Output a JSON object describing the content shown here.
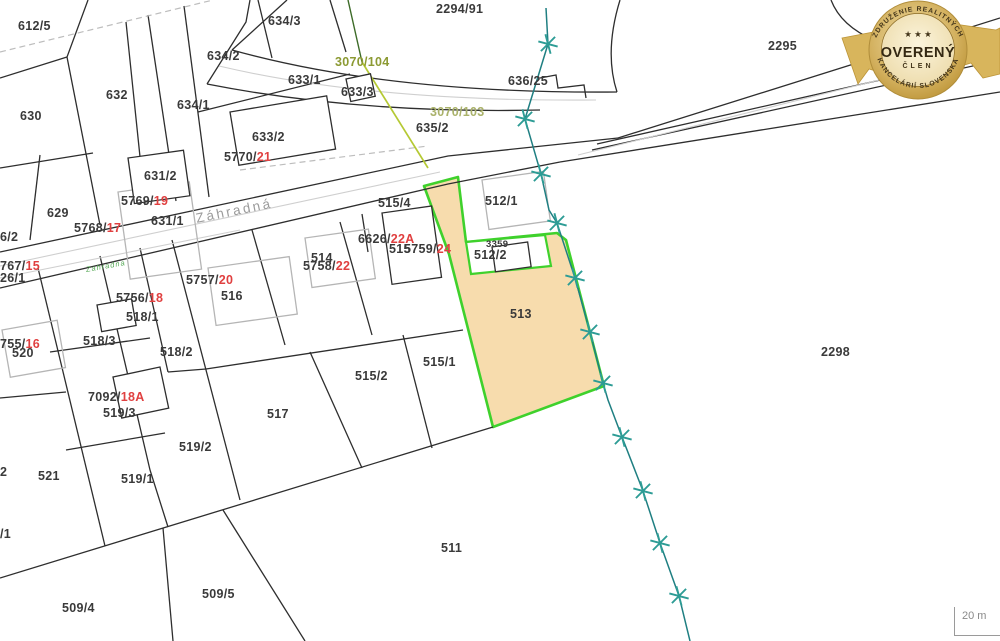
{
  "map": {
    "street_label": "Záhradná",
    "street_small_label": "Zahradna",
    "scale_label": "20 m",
    "colors": {
      "highlight_parcel_fill": "#F7DCAD",
      "highlight_border_green": "#3FD12C",
      "survey_line_teal": "#2D9C95",
      "red_number": "#E04040",
      "olive_number": "#8C9A33",
      "parcel_text": "#3A3A3A",
      "street_text": "#9B9B9B",
      "boundary_line": "#2E2E2E",
      "building_gray": "#B5B5B5",
      "badge_gold": "#C9A445"
    },
    "highlighted_parcel": "513",
    "labels": [
      {
        "text": "612/5",
        "x": 18,
        "y": 20
      },
      {
        "text": "2294/91",
        "x": 436,
        "y": 3
      },
      {
        "text": "634/3",
        "x": 268,
        "y": 15
      },
      {
        "text": "634/2",
        "x": 207,
        "y": 50
      },
      {
        "text": "633/1",
        "x": 288,
        "y": 74
      },
      {
        "text": "633/3",
        "x": 341,
        "y": 86
      },
      {
        "text": "3070/104",
        "x": 335,
        "y": 56,
        "cls": "olive",
        "name": "olive-label"
      },
      {
        "text": "3070/103",
        "x": 430,
        "y": 106,
        "cls": "olive2",
        "name": "olive-label"
      },
      {
        "text": "636/25",
        "x": 508,
        "y": 75
      },
      {
        "text": "635/2",
        "x": 416,
        "y": 122
      },
      {
        "text": "632",
        "x": 106,
        "y": 89
      },
      {
        "text": "634/1",
        "x": 177,
        "y": 99
      },
      {
        "text": "630",
        "x": 20,
        "y": 110
      },
      {
        "text": "633/2",
        "x": 252,
        "y": 131
      },
      {
        "text": "631/2",
        "x": 144,
        "y": 170
      },
      {
        "text": "629",
        "x": 47,
        "y": 207
      },
      {
        "text": "631/1",
        "x": 151,
        "y": 215
      },
      {
        "text": "5770/",
        "red": "21",
        "x": 224,
        "y": 151,
        "name": "survey-number"
      },
      {
        "text": "5769/",
        "red": "19",
        "x": 121,
        "y": 195,
        "name": "survey-number"
      },
      {
        "text": "5768/",
        "red": "17",
        "x": 74,
        "y": 222,
        "name": "survey-number"
      },
      {
        "text": "767/",
        "red": "15",
        "x": 0,
        "y": 260,
        "name": "survey-number"
      },
      {
        "text": "6/2",
        "x": 0,
        "y": 231
      },
      {
        "text": "26/1",
        "x": 0,
        "y": 272
      },
      {
        "text": "515/4",
        "x": 378,
        "y": 197
      },
      {
        "text": "512/1",
        "x": 485,
        "y": 195
      },
      {
        "text": "6626/",
        "red": "22A",
        "x": 358,
        "y": 233,
        "name": "survey-number"
      },
      {
        "text": "515",
        "x": 389,
        "y": 243
      },
      {
        "text": "5759/",
        "red": "24",
        "x": 404,
        "y": 243,
        "name": "survey-number"
      },
      {
        "text": "3359",
        "x": 486,
        "y": 240,
        "cls": "small"
      },
      {
        "text": "512/2",
        "x": 474,
        "y": 249
      },
      {
        "text": "514",
        "x": 311,
        "y": 252
      },
      {
        "text": "5758/",
        "red": "22",
        "x": 303,
        "y": 260,
        "name": "survey-number"
      },
      {
        "text": "5757/",
        "red": "20",
        "x": 186,
        "y": 274,
        "name": "survey-number"
      },
      {
        "text": "516",
        "x": 221,
        "y": 290
      },
      {
        "text": "5756/",
        "red": "18",
        "x": 116,
        "y": 292,
        "name": "survey-number"
      },
      {
        "text": "518/1",
        "x": 126,
        "y": 311
      },
      {
        "text": "513",
        "x": 510,
        "y": 308
      },
      {
        "text": "2295",
        "x": 768,
        "y": 40
      },
      {
        "text": "2298",
        "x": 821,
        "y": 346
      },
      {
        "text": "518/3",
        "x": 83,
        "y": 335
      },
      {
        "text": "755/",
        "red": "16",
        "x": 0,
        "y": 338,
        "name": "survey-number"
      },
      {
        "text": "520",
        "x": 12,
        "y": 347
      },
      {
        "text": "518/2",
        "x": 160,
        "y": 346
      },
      {
        "text": "515/2",
        "x": 355,
        "y": 370
      },
      {
        "text": "515/1",
        "x": 423,
        "y": 356
      },
      {
        "text": "7092/",
        "red": "18A",
        "x": 88,
        "y": 391,
        "name": "survey-number"
      },
      {
        "text": "519/3",
        "x": 103,
        "y": 407
      },
      {
        "text": "517",
        "x": 267,
        "y": 408
      },
      {
        "text": "519/2",
        "x": 179,
        "y": 441
      },
      {
        "text": "2",
        "x": 0,
        "y": 466
      },
      {
        "text": "521",
        "x": 38,
        "y": 470
      },
      {
        "text": "519/1",
        "x": 121,
        "y": 473
      },
      {
        "text": "/1",
        "x": 0,
        "y": 528
      },
      {
        "text": "511",
        "x": 441,
        "y": 542
      },
      {
        "text": "509/5",
        "x": 202,
        "y": 588
      },
      {
        "text": "509/4",
        "x": 62,
        "y": 602
      }
    ]
  },
  "badge": {
    "arc_top": "ZDRUŽENIE REALITNÝCH",
    "stars": "★ ★ ★",
    "title": "OVERENÝ",
    "subtitle": "ČLEN",
    "arc_bottom": "KANCELÁRIÍ SLOVENSKA"
  }
}
